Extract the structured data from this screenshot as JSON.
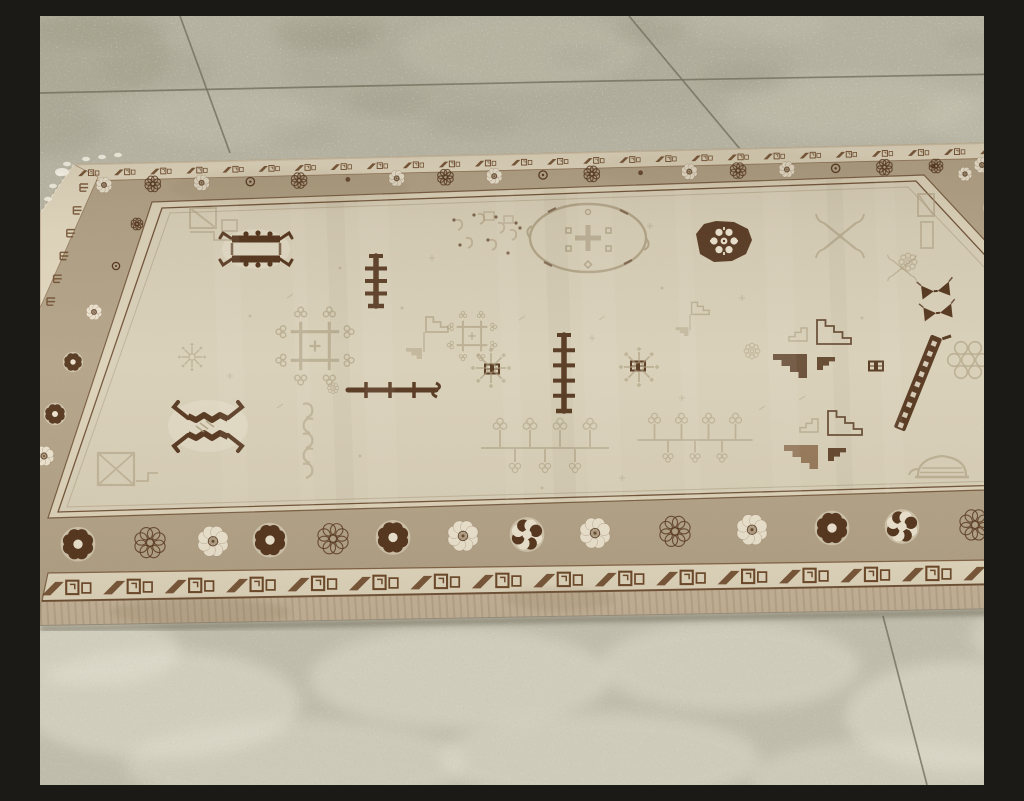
{
  "scene": {
    "caption": "Antique East Turkestan Khotan rug with a faded ivory field of geometric motifs, tan rosette border and brown meander guard borders, lying at an angle on a speckled concrete tile floor."
  },
  "palette": {
    "floor_base": "#b4b1a0",
    "floor_light": "#cdcab8",
    "floor_dark": "#8e8b77",
    "floor_moss": "#989a7e",
    "grout": "#73705e",
    "rug_selvedge": "#c7b69b",
    "meander_ground": "#e2d8c0",
    "meander_brown": "#6a4627",
    "border_tan": "#b2a287",
    "border_line": "#5e3d22",
    "guard_cream": "#dcd2b9",
    "field_ivory": "#d8cfb8",
    "field_faded": "#a69778",
    "motif_brown": "#54351d",
    "rosette_cream": "#ebe3cf",
    "fringe_white": "#edeadd",
    "edge_light": "#d0c4a9"
  },
  "floor": {
    "grout_lines": [
      [
        140,
        0,
        190,
        137
      ],
      [
        0,
        77,
        512,
        66
      ],
      [
        512,
        66,
        1024,
        57
      ],
      [
        589,
        0,
        700,
        133
      ],
      [
        843,
        600,
        887,
        769
      ]
    ],
    "dark_stains": [
      {
        "x": 285,
        "y": 22,
        "rx": 50,
        "ry": 16,
        "o": 0.22
      },
      {
        "x": 348,
        "y": 86,
        "rx": 42,
        "ry": 15,
        "o": 0.18
      },
      {
        "x": 612,
        "y": 14,
        "rx": 38,
        "ry": 13,
        "o": 0.2
      },
      {
        "x": 700,
        "y": 60,
        "rx": 42,
        "ry": 14,
        "o": 0.16
      },
      {
        "x": 118,
        "y": 52,
        "rx": 60,
        "ry": 20,
        "o": 0.13
      },
      {
        "x": 10,
        "y": 110,
        "rx": 55,
        "ry": 30,
        "o": 0.22
      },
      {
        "x": 935,
        "y": 28,
        "rx": 32,
        "ry": 12,
        "o": 0.13
      },
      {
        "x": 432,
        "y": 108,
        "rx": 46,
        "ry": 15,
        "o": 0.13
      },
      {
        "x": 540,
        "y": 42,
        "rx": 30,
        "ry": 11,
        "o": 0.1
      },
      {
        "x": 262,
        "y": 118,
        "rx": 40,
        "ry": 13,
        "o": 0.11
      },
      {
        "x": 500,
        "y": 52,
        "rx": 260,
        "ry": 60,
        "o": 0.1
      },
      {
        "x": 60,
        "y": 14,
        "rx": 70,
        "ry": 18,
        "o": 0.18
      }
    ],
    "moss_patches": [
      {
        "x": 40,
        "y": 40,
        "rx": 90,
        "ry": 45,
        "o": 0.28
      },
      {
        "x": 290,
        "y": 10,
        "rx": 60,
        "ry": 20,
        "o": 0.2
      }
    ],
    "light_patches": [
      {
        "x": 480,
        "y": 34,
        "rx": 120,
        "ry": 38,
        "o": 0.3
      },
      {
        "x": 810,
        "y": 92,
        "rx": 125,
        "ry": 33,
        "o": 0.28
      },
      {
        "x": 185,
        "y": 102,
        "rx": 88,
        "ry": 28,
        "o": 0.22
      },
      {
        "x": 955,
        "y": 102,
        "rx": 75,
        "ry": 28,
        "o": 0.26
      },
      {
        "x": 700,
        "y": 8,
        "rx": 90,
        "ry": 20,
        "o": 0.2
      }
    ],
    "bottom_lights": [
      {
        "x": 120,
        "y": 688,
        "rx": 140,
        "ry": 55,
        "o": 0.45
      },
      {
        "x": 420,
        "y": 662,
        "rx": 150,
        "ry": 50,
        "o": 0.42
      },
      {
        "x": 690,
        "y": 650,
        "rx": 130,
        "ry": 45,
        "o": 0.4
      },
      {
        "x": 920,
        "y": 700,
        "rx": 115,
        "ry": 55,
        "o": 0.45
      },
      {
        "x": 255,
        "y": 748,
        "rx": 170,
        "ry": 45,
        "o": 0.35
      },
      {
        "x": 560,
        "y": 742,
        "rx": 160,
        "ry": 45,
        "o": 0.4
      },
      {
        "x": 850,
        "y": 762,
        "rx": 140,
        "ry": 38,
        "o": 0.35
      },
      {
        "x": 55,
        "y": 635,
        "rx": 85,
        "ry": 35,
        "o": 0.45
      },
      {
        "x": 990,
        "y": 620,
        "rx": 60,
        "ry": 30,
        "o": 0.4
      }
    ]
  },
  "rug": {
    "outline": [
      [
        33,
        148
      ],
      [
        967,
        126
      ],
      [
        1024,
        228
      ],
      [
        1024,
        592
      ],
      [
        0,
        610
      ],
      [
        0,
        196
      ]
    ],
    "field": [
      [
        122,
        192
      ],
      [
        876,
        165
      ],
      [
        955,
        250
      ],
      [
        1000,
        468
      ],
      [
        18,
        496
      ]
    ],
    "guard": [
      [
        112,
        186
      ],
      [
        884,
        159
      ],
      [
        965,
        246
      ],
      [
        1012,
        472
      ],
      [
        8,
        502
      ]
    ],
    "inner_line": [
      [
        130,
        197
      ],
      [
        868,
        171
      ],
      [
        947,
        254
      ],
      [
        992,
        464
      ],
      [
        27,
        491
      ]
    ],
    "top_meander_strip": [
      [
        33,
        148
      ],
      [
        967,
        126
      ],
      [
        962,
        142
      ],
      [
        40,
        165
      ]
    ],
    "bottom_meander_strip": [
      [
        8,
        557
      ],
      [
        1024,
        543
      ],
      [
        1024,
        567
      ],
      [
        2,
        585
      ]
    ],
    "bottom_selvedge": [
      [
        2,
        585
      ],
      [
        1024,
        567
      ],
      [
        1024,
        593
      ],
      [
        0,
        611
      ]
    ],
    "left_meander_strip": [
      [
        33,
        148
      ],
      [
        58,
        161
      ],
      [
        0,
        292
      ],
      [
        0,
        196
      ]
    ],
    "right_edge_strip": [
      [
        967,
        126
      ],
      [
        1024,
        228
      ],
      [
        1024,
        244
      ],
      [
        975,
        141
      ]
    ],
    "top_meander": {
      "from": [
        48,
        157
      ],
      "to": [
        950,
        135
      ],
      "count": 26,
      "scale": 0.52
    },
    "bottom_meander": {
      "from": [
        25,
        572
      ],
      "to": [
        1008,
        556
      ],
      "count": 17,
      "scale": 1.22
    },
    "left_marks": {
      "from": [
        40,
        168
      ],
      "to": [
        7,
        282
      ],
      "count": 6
    },
    "chain": {
      "from": [
        977,
        148
      ],
      "to": [
        1021,
        240
      ],
      "count": 8
    },
    "rosettes": {
      "top": {
        "from": [
          64,
          169
        ],
        "to": [
          942,
          149
        ],
        "count": 19,
        "r": 8,
        "variants": [
          "cream",
          "outline",
          "cream",
          "ring",
          "outline",
          "dot"
        ]
      },
      "bottom": {
        "xs": [
          38,
          110,
          173,
          230,
          293,
          353,
          423,
          487,
          555,
          635,
          712,
          792,
          862,
          935,
          1008
        ],
        "y_from": 529,
        "y_to": 507,
        "r": 15.5,
        "variants": [
          "dark",
          "outline",
          "cream",
          "dark",
          "outline",
          "dark",
          "cream",
          "mix",
          "cream",
          "outline",
          "cream",
          "dark",
          "mix",
          "outline",
          "dark"
        ]
      },
      "left": [
        {
          "x": 97,
          "y": 208,
          "r": 6,
          "v": "outline"
        },
        {
          "x": 76,
          "y": 250,
          "r": 7,
          "v": "ring"
        },
        {
          "x": 54,
          "y": 296,
          "r": 8,
          "v": "cream"
        },
        {
          "x": 33,
          "y": 346,
          "r": 9,
          "v": "dark"
        },
        {
          "x": 15,
          "y": 398,
          "r": 10,
          "v": "dark"
        },
        {
          "x": 4,
          "y": 440,
          "r": 10,
          "v": "cream"
        }
      ],
      "right": [
        {
          "x": 896,
          "y": 150,
          "r": 7,
          "v": "outline"
        },
        {
          "x": 925,
          "y": 158,
          "r": 7,
          "v": "cream"
        },
        {
          "x": 952,
          "y": 192,
          "r": 8,
          "v": "dark"
        },
        {
          "x": 969,
          "y": 224,
          "r": 9,
          "v": "cream"
        },
        {
          "x": 985,
          "y": 260,
          "r": 9,
          "v": "outline"
        },
        {
          "x": 997,
          "y": 300,
          "r": 10,
          "v": "cream"
        },
        {
          "x": 1007,
          "y": 344,
          "r": 10,
          "v": "outline"
        },
        {
          "x": 1014,
          "y": 390,
          "r": 11,
          "v": "cream"
        },
        {
          "x": 1019,
          "y": 434,
          "r": 11,
          "v": "outline"
        }
      ]
    },
    "stains": [
      {
        "x": 160,
        "y": 596,
        "rx": 90,
        "ry": 14,
        "o": 0.15
      },
      {
        "x": 520,
        "y": 583,
        "rx": 55,
        "ry": 12,
        "o": 0.12
      },
      {
        "x": 250,
        "y": 172,
        "rx": 120,
        "ry": 20,
        "o": 0.08
      },
      {
        "x": 700,
        "y": 152,
        "rx": 150,
        "ry": 18,
        "o": 0.06
      }
    ],
    "streaks_light": [
      {
        "x": 190,
        "w": 26
      },
      {
        "x": 262,
        "w": 14
      },
      {
        "x": 338,
        "w": 30
      },
      {
        "x": 470,
        "w": 18
      },
      {
        "x": 560,
        "w": 34
      },
      {
        "x": 648,
        "w": 16
      },
      {
        "x": 742,
        "w": 28
      },
      {
        "x": 850,
        "w": 20
      }
    ],
    "streaks_dark": [
      {
        "x": 300,
        "w": 18
      },
      {
        "x": 520,
        "w": 22
      },
      {
        "x": 800,
        "w": 16
      }
    ],
    "fringe": [
      [
        20,
        158
      ],
      [
        13,
        170
      ],
      [
        27,
        148
      ],
      [
        8,
        183
      ],
      [
        46,
        143
      ],
      [
        62,
        141
      ],
      [
        78,
        139
      ],
      [
        992,
        136
      ],
      [
        1001,
        147
      ],
      [
        1010,
        158
      ],
      [
        1017,
        169
      ]
    ]
  },
  "motifs": [
    {
      "t": "hookSquare",
      "x": 216,
      "y": 233,
      "s": 1
    },
    {
      "t": "hookX",
      "x": 168,
      "y": 410,
      "s": 1
    },
    {
      "t": "poleV",
      "x": 336,
      "y": 265,
      "h": 50,
      "bars": 3
    },
    {
      "t": "poleV",
      "x": 524,
      "y": 357,
      "h": 76,
      "bars": 4
    },
    {
      "t": "poleH",
      "x": 352,
      "y": 374,
      "w": 88
    },
    {
      "t": "roundMedallion",
      "x": 684,
      "y": 226,
      "s": 1
    },
    {
      "t": "mothPair",
      "x": 897,
      "y": 287,
      "s": 1
    },
    {
      "t": "pinwheel",
      "x": 772,
      "y": 333,
      "s": 1,
      "v": 1
    },
    {
      "t": "pinwheel",
      "x": 783,
      "y": 424,
      "s": 1,
      "v": 2
    },
    {
      "t": "ladder",
      "x": 878,
      "y": 367,
      "s": 1,
      "r": 22
    },
    {
      "t": "bb",
      "x": 452,
      "y": 353
    },
    {
      "t": "bb",
      "x": 598,
      "y": 350
    },
    {
      "t": "bb",
      "x": 836,
      "y": 350
    },
    {
      "t": "cornerTL",
      "x": 172,
      "y": 208
    },
    {
      "t": "cornerBL",
      "x": 78,
      "y": 455
    },
    {
      "t": "cornerTR",
      "x": 888,
      "y": 208
    },
    {
      "t": "cornerBR",
      "x": 966,
      "y": 428
    },
    {
      "t": "ovalMedallion",
      "x": 548,
      "y": 222
    },
    {
      "t": "script",
      "x": 450,
      "y": 226
    },
    {
      "t": "branchX",
      "x": 800,
      "y": 220,
      "s": 1
    },
    {
      "t": "branchX",
      "x": 862,
      "y": 252,
      "s": 0.6
    },
    {
      "t": "snowflake",
      "x": 451,
      "y": 352,
      "s": 1
    },
    {
      "t": "snowflake",
      "x": 599,
      "y": 351,
      "s": 1
    },
    {
      "t": "snowflake",
      "x": 152,
      "y": 341,
      "s": 0.7
    },
    {
      "t": "crossLattice",
      "x": 275,
      "y": 330,
      "s": 1.1
    },
    {
      "t": "crossLattice",
      "x": 432,
      "y": 320,
      "s": 0.7
    },
    {
      "t": "curlColumn",
      "x": 268,
      "y": 432
    },
    {
      "t": "flagTriangles",
      "x": 384,
      "y": 318,
      "s": 1
    },
    {
      "t": "flagTriangles",
      "x": 650,
      "y": 300,
      "s": 0.8
    },
    {
      "t": "pomegranateRow",
      "x": 505,
      "y": 432,
      "s": 1
    },
    {
      "t": "pomegranateRow",
      "x": 655,
      "y": 424,
      "s": 0.9
    },
    {
      "t": "grapeCluster",
      "x": 928,
      "y": 344,
      "s": 1
    },
    {
      "t": "teapot",
      "x": 902,
      "y": 453
    },
    {
      "t": "rosetteOutline",
      "x": 868,
      "y": 246,
      "s": 0.8
    },
    {
      "t": "rosetteOutline",
      "x": 712,
      "y": 335,
      "s": 0.7
    },
    {
      "t": "rosetteOutline",
      "x": 293,
      "y": 372,
      "s": 0.5
    }
  ],
  "scatter": [
    [
      300,
      252
    ],
    [
      392,
      242
    ],
    [
      562,
      302
    ],
    [
      622,
      272
    ],
    [
      702,
      282
    ],
    [
      762,
      382
    ],
    [
      822,
      302
    ],
    [
      552,
      322
    ],
    [
      482,
      302
    ],
    [
      362,
      292
    ],
    [
      642,
      382
    ],
    [
      722,
      392
    ],
    [
      502,
      472
    ],
    [
      582,
      462
    ],
    [
      250,
      280
    ],
    [
      210,
      300
    ],
    [
      190,
      360
    ],
    [
      240,
      390
    ],
    [
      320,
      440
    ],
    [
      610,
      210
    ]
  ]
}
